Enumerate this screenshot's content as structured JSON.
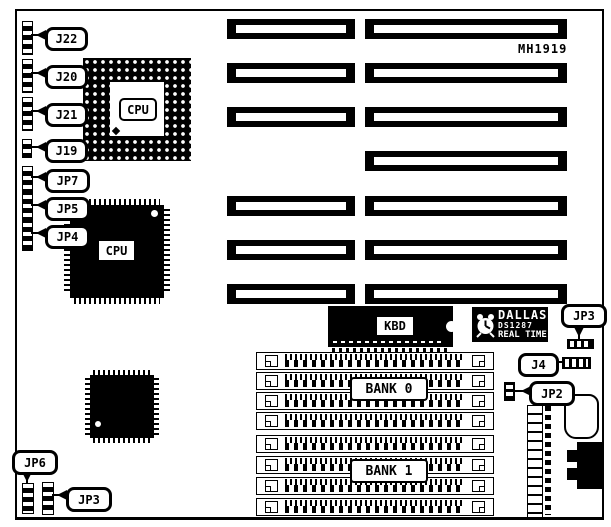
{
  "board": {
    "part_number": "MH1919",
    "left_jumpers": [
      {
        "label": "J22"
      },
      {
        "label": "J20"
      },
      {
        "label": "J21"
      },
      {
        "label": "J19"
      },
      {
        "label": "JP7"
      },
      {
        "label": "JP5"
      },
      {
        "label": "JP4"
      }
    ],
    "pga_cpu_label": "CPU",
    "qfp_cpu_label": "CPU",
    "keyboard_bios_label": "KBD",
    "rtc_chip": {
      "brand": "DALLAS",
      "model": "DS1287",
      "type": "REAL TIME"
    },
    "jp3_top_label": "JP3",
    "j4_label": "J4",
    "jp2_label": "JP2",
    "memory_banks": [
      {
        "label": "BANK 0"
      },
      {
        "label": "BANK 1"
      }
    ],
    "jp6_label": "JP6",
    "jp3_bottom_label": "JP3",
    "colors": {
      "ink": "#000000",
      "paper": "#ffffff"
    }
  }
}
